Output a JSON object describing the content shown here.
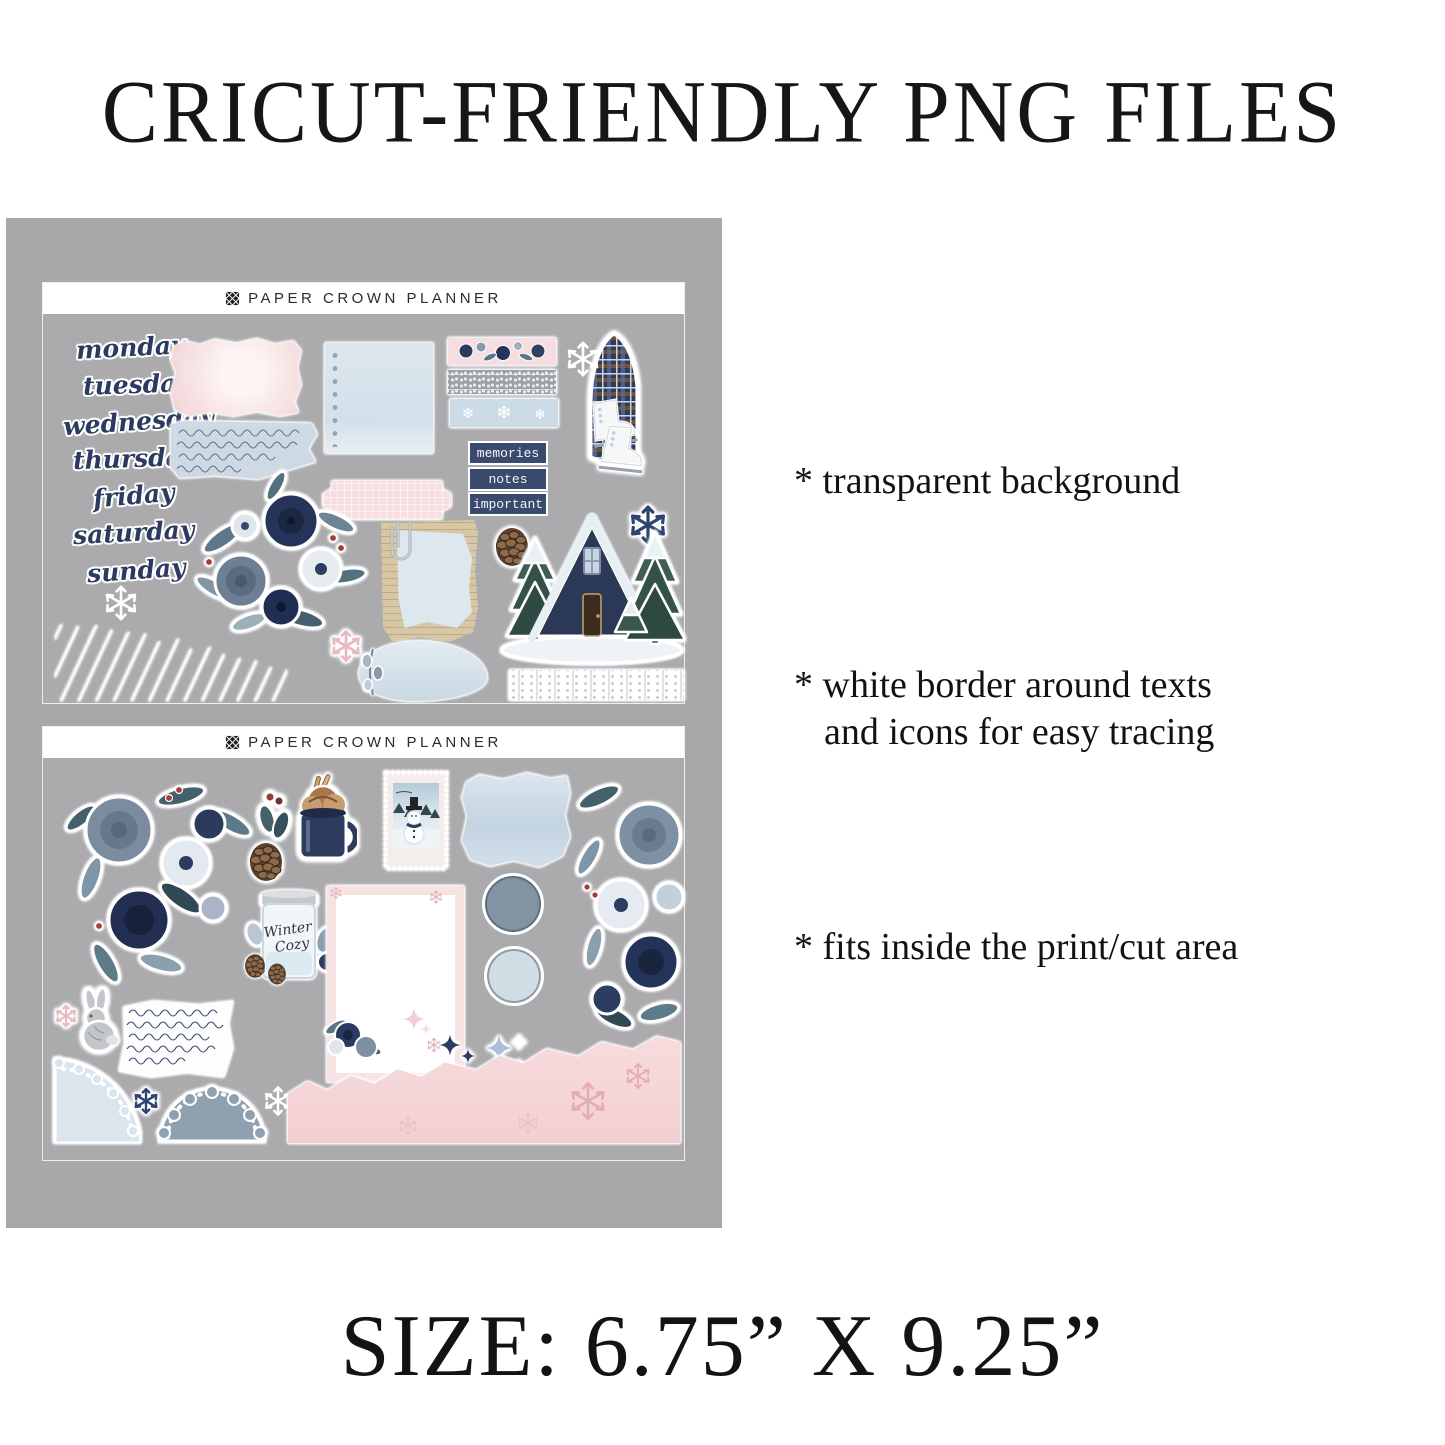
{
  "page": {
    "title": "CRICUT-FRIENDLY PNG FILES",
    "features": [
      {
        "lines": [
          "* transparent background"
        ]
      },
      {
        "lines": [
          "* white border around texts",
          "and icons for easy tracing"
        ]
      },
      {
        "lines": [
          "* fits inside the print/cut area"
        ]
      }
    ],
    "size_label": "SIZE: 6.75” X 9.25”"
  },
  "brand": {
    "name": "PAPER CROWN PLANNER",
    "logo_icon": "crest-monogram-icon"
  },
  "sheet1": {
    "weekdays": [
      "monday",
      "tuesday",
      "wednesday",
      "thursday",
      "friday",
      "saturday",
      "sunday"
    ],
    "tags": [
      "memories",
      "notes",
      "important"
    ],
    "stickers": [
      "pink-torn-paper",
      "handwriting-paper",
      "notebook-paper",
      "pink-ticket",
      "winter-floral-bouquet",
      "floral-washi-strip",
      "fair-isle-washi-strip",
      "snowflake-washi-strip",
      "white-snowflake",
      "ice-skates-with-plaid-scarf",
      "navy-snowflake",
      "pinecone",
      "torn-note-with-paperclip",
      "pink-snowflake",
      "torn-blue-paper",
      "brushstroke-label",
      "a-frame-cabin-with-snowy-trees",
      "lace-trim-strip"
    ]
  },
  "sheet2": {
    "candle_label": [
      "Winter",
      "Cozy"
    ],
    "stickers": [
      "winter-floral-corner",
      "holly-sprig",
      "hot-cocoa-mug",
      "pinecone",
      "winter-candle",
      "snowman-stamp",
      "paint-swatch",
      "dark-blue-dot",
      "light-blue-dot",
      "winter-floral-edge",
      "pink-snowflake-note-card",
      "bunny",
      "handwriting-scrap",
      "pink-sparkles",
      "navy-sparkles",
      "white-sparkle-cluster",
      "corner-doily",
      "half-doily",
      "navy-snowflake",
      "white-snowflake",
      "torn-pink-paper"
    ]
  },
  "colors": {
    "panel_gray": "#a8a8ab",
    "navy": "#2c3a5e",
    "dusty_blue": "#7e90a3",
    "pale_blue": "#d9e3ec",
    "blush_pink": "#f6dee0",
    "white": "#ffffff"
  }
}
